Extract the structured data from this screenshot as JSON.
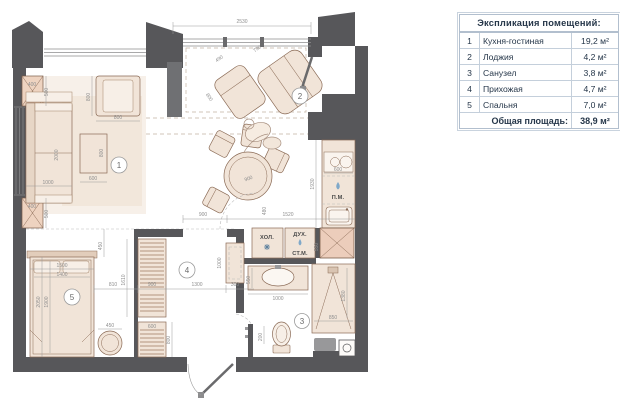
{
  "legend": {
    "title": "Экспликация помещений:",
    "rows": [
      {
        "num": "1",
        "name": "Кухня-гостиная",
        "area": "19,2 м²"
      },
      {
        "num": "2",
        "name": "Лоджия",
        "area": "4,2 м²"
      },
      {
        "num": "3",
        "name": "Санузел",
        "area": "3,8 м²"
      },
      {
        "num": "4",
        "name": "Прихожая",
        "area": "4,7 м²"
      },
      {
        "num": "5",
        "name": "Спальня",
        "area": "7,0 м²"
      }
    ],
    "total_label": "Общая площадь:",
    "total_value": "38,9 м²"
  },
  "plan": {
    "room_markers": {
      "r1": "1",
      "r2": "2",
      "r3": "3",
      "r4": "4",
      "r5": "5"
    },
    "appliances": {
      "fridge": "ХОЛ.",
      "oven": "ДУХ.",
      "washing_machine": "СТ.М.",
      "dishwasher": "П.М."
    },
    "dims": {
      "top_window": "2530",
      "chair_small": "490",
      "chair_large": "790",
      "chair_depth": "800",
      "armchair_depth": "800",
      "armchair_width": "800",
      "pier1_w": "400",
      "pier1_h": "500",
      "pier2_w": "400",
      "pier2_h": "500",
      "sofa_len": "2000",
      "sofa_w": "1000",
      "table_d": "800",
      "table_w": "600",
      "dining_d": "900",
      "counter_w": "600",
      "kitchen_len": "1930",
      "shaft_w": "550",
      "hall_opening": "900",
      "hall_gap": "1520",
      "hall_door": "480",
      "bench_len": "1000",
      "bench_d": "300",
      "hall_w": "1300",
      "wardrobe_w": "900",
      "ward_to_bed": "810",
      "wardrobe_h": "1610",
      "shoe_w": "600",
      "entry_d": "800",
      "bed_gap": "450",
      "bed_w1": "1500",
      "bed_w2": "1400",
      "bed_l1": "2050",
      "bed_l2": "1900",
      "stool_d": "450",
      "basin_d": "550",
      "basin_w": "1000",
      "shower_l": "1380",
      "shower_w": "850",
      "toilet_off": "200"
    }
  }
}
